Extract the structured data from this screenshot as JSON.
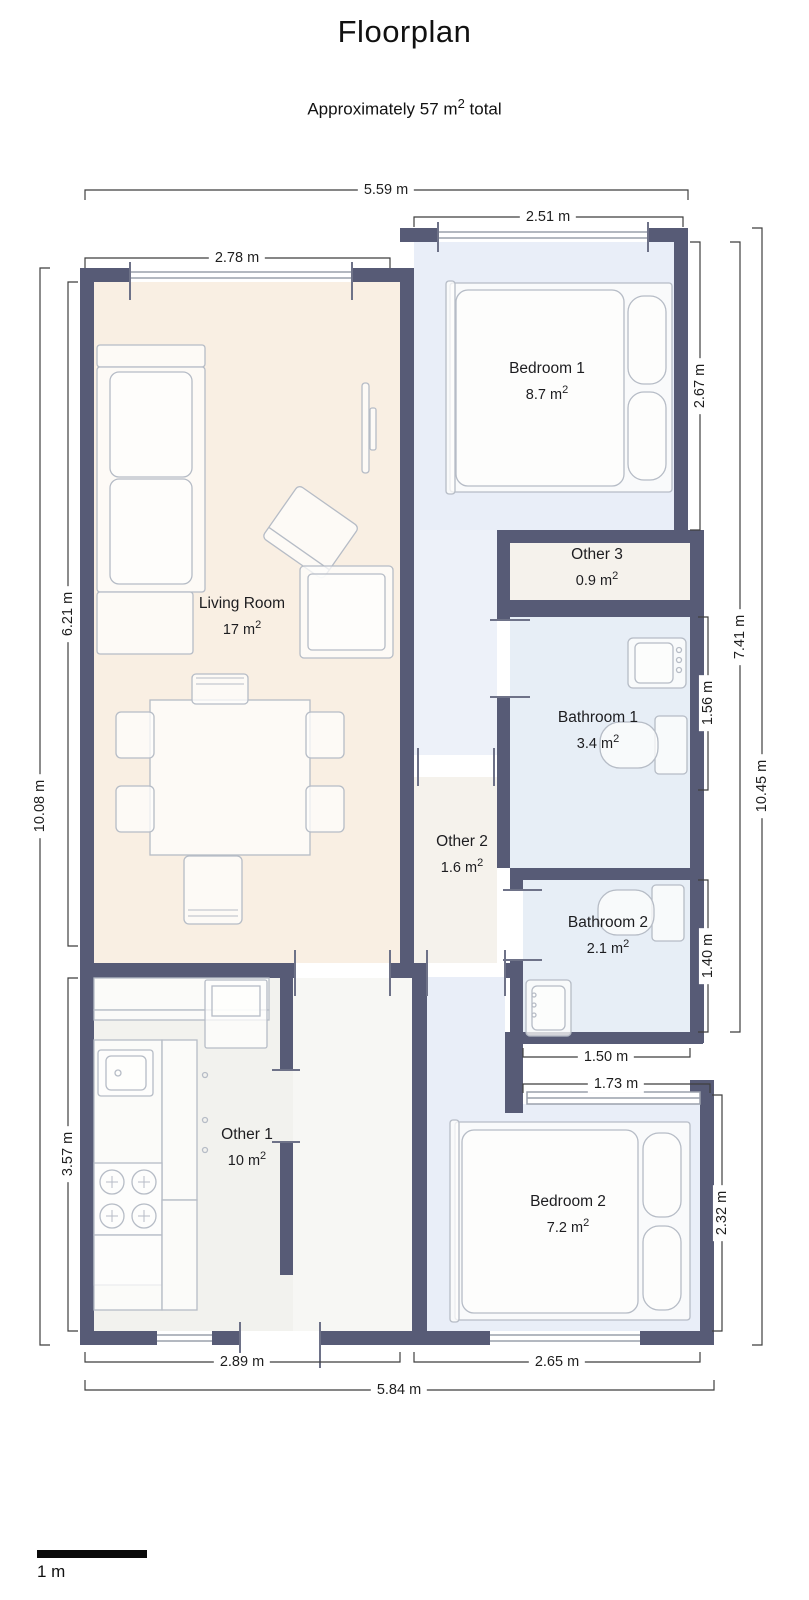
{
  "header": {
    "title": "Floorplan",
    "subtitle_prefix": "Approximately 57 m",
    "subtitle_sup": "2",
    "subtitle_suffix": " total"
  },
  "rooms": [
    {
      "name": "Living Room",
      "area": "17 m",
      "sup": "2"
    },
    {
      "name": "Bedroom 1",
      "area": "8.7 m",
      "sup": "2"
    },
    {
      "name": "Other 3",
      "area": "0.9 m",
      "sup": "2"
    },
    {
      "name": "Bathroom 1",
      "area": "3.4 m",
      "sup": "2"
    },
    {
      "name": "Other 2",
      "area": "1.6 m",
      "sup": "2"
    },
    {
      "name": "Bathroom 2",
      "area": "2.1 m",
      "sup": "2"
    },
    {
      "name": "Other 1",
      "area": "10 m",
      "sup": "2"
    },
    {
      "name": "Bedroom 2",
      "area": "7.2 m",
      "sup": "2"
    }
  ],
  "dims": [
    {
      "label": "5.59 m"
    },
    {
      "label": "2.51 m"
    },
    {
      "label": "2.78 m"
    },
    {
      "label": "6.21 m"
    },
    {
      "label": "10.08 m"
    },
    {
      "label": "3.57 m"
    },
    {
      "label": "2.67 m"
    },
    {
      "label": "1.56 m"
    },
    {
      "label": "1.40 m"
    },
    {
      "label": "2.32 m"
    },
    {
      "label": "7.41 m"
    },
    {
      "label": "10.45 m"
    },
    {
      "label": "1.50 m"
    },
    {
      "label": "1.73 m"
    },
    {
      "label": "2.89 m"
    },
    {
      "label": "2.65 m"
    },
    {
      "label": "5.84 m"
    }
  ],
  "scale_bar": {
    "label": "1 m"
  },
  "colors": {
    "wall": "#575b76",
    "living_room_floor": "#f9efe3",
    "bedroom_floor": "#e9eef8",
    "bathroom_floor": "#e7eef6",
    "other_floor": "#f5f2ec",
    "kitchen_floor": "#f2f2ee",
    "entry_floor": "#f7f7f4",
    "furniture_outline": "#b6bcc6",
    "dimension_line": "#3f3f3f"
  }
}
